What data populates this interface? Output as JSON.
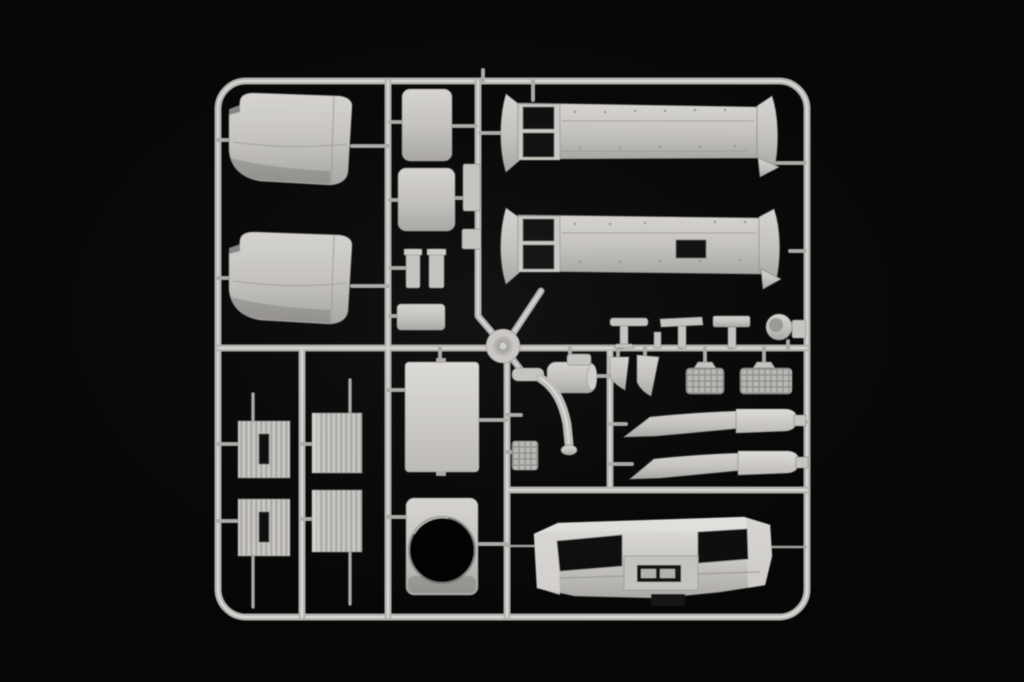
{
  "scene": {
    "medium": "photograph",
    "subject": "Injection-moulded plastic model kit sprue (parts tree) of truck cab components in light grey styrene, photographed on a black background",
    "palette": {
      "background": "#060606",
      "plastic_base": "#c9c7c3",
      "plastic_highlight": "#e2e0dc",
      "plastic_shadow": "#a5a3a0",
      "opening_black": "#0a0a0a"
    },
    "sprue": {
      "frame_shape": "rounded rectangle runner frame with internal cross runners",
      "material": "light grey polystyrene",
      "part_count_visible": 31
    },
    "parts": [
      {
        "id": "fender-upper",
        "label": "wheel-arch fender shell (upper left)"
      },
      {
        "id": "fender-lower",
        "label": "wheel-arch fender shell (lower left)"
      },
      {
        "id": "ribbed-panel-1",
        "label": "ribbed step/battery panel with slot"
      },
      {
        "id": "ribbed-panel-2",
        "label": "ribbed step/battery panel with slot"
      },
      {
        "id": "ribbed-panel-3",
        "label": "ribbed step/battery panel"
      },
      {
        "id": "ribbed-panel-4",
        "label": "ribbed step/battery panel"
      },
      {
        "id": "hatch-panel-1",
        "label": "small rounded hatch panel"
      },
      {
        "id": "hatch-panel-2",
        "label": "small rounded hatch panel"
      },
      {
        "id": "pillar-bar-1",
        "label": "small pillar bar"
      },
      {
        "id": "pillar-bar-2",
        "label": "small pillar bar"
      },
      {
        "id": "small-plate",
        "label": "small rectangular plate"
      },
      {
        "id": "vertical-plate",
        "label": "narrow vertical plate"
      },
      {
        "id": "square-plate",
        "label": "small square plate"
      },
      {
        "id": "side-skirt-upper",
        "label": "long side-skirt fairing with two window cut-outs"
      },
      {
        "id": "side-skirt-lower",
        "label": "long side-skirt fairing with cut-outs and rectangular hole"
      },
      {
        "id": "mirror-arm-1",
        "label": "mirror arm (T-shaped)"
      },
      {
        "id": "mirror-arm-2",
        "label": "mirror arm (T-shaped)"
      },
      {
        "id": "step-plate",
        "label": "flat step plate on post"
      },
      {
        "id": "horn-cover",
        "label": "round horn/lamp cover"
      },
      {
        "id": "side-tab",
        "label": "small side tab plate"
      },
      {
        "id": "mirror-wedge-1",
        "label": "wedge-shaped mirror housing"
      },
      {
        "id": "mirror-wedge-2",
        "label": "wedge-shaped mirror housing"
      },
      {
        "id": "air-tank",
        "label": "air tank with filler cap"
      },
      {
        "id": "mesh-step-1",
        "label": "cross-hatched entry step grille"
      },
      {
        "id": "mesh-step-2",
        "label": "cross-hatched entry step grille"
      },
      {
        "id": "visor-blade-upper",
        "label": "two-piece sun-visor / deflector blade"
      },
      {
        "id": "visor-blade-lower",
        "label": "two-piece sun-visor / deflector blade"
      },
      {
        "id": "roof-panel",
        "label": "large flat roof panel"
      },
      {
        "id": "round-opening-panel",
        "label": "panel with large circular opening"
      },
      {
        "id": "mesh-square",
        "label": "small cross-hatched grille square"
      },
      {
        "id": "exhaust-pipe",
        "label": "curved exhaust pipe with flange"
      },
      {
        "id": "hub-disc",
        "label": "conical hub disc at runner junction"
      },
      {
        "id": "front-bumper",
        "label": "truck front bumper with headlamp recesses and licence-plate recess"
      }
    ]
  }
}
